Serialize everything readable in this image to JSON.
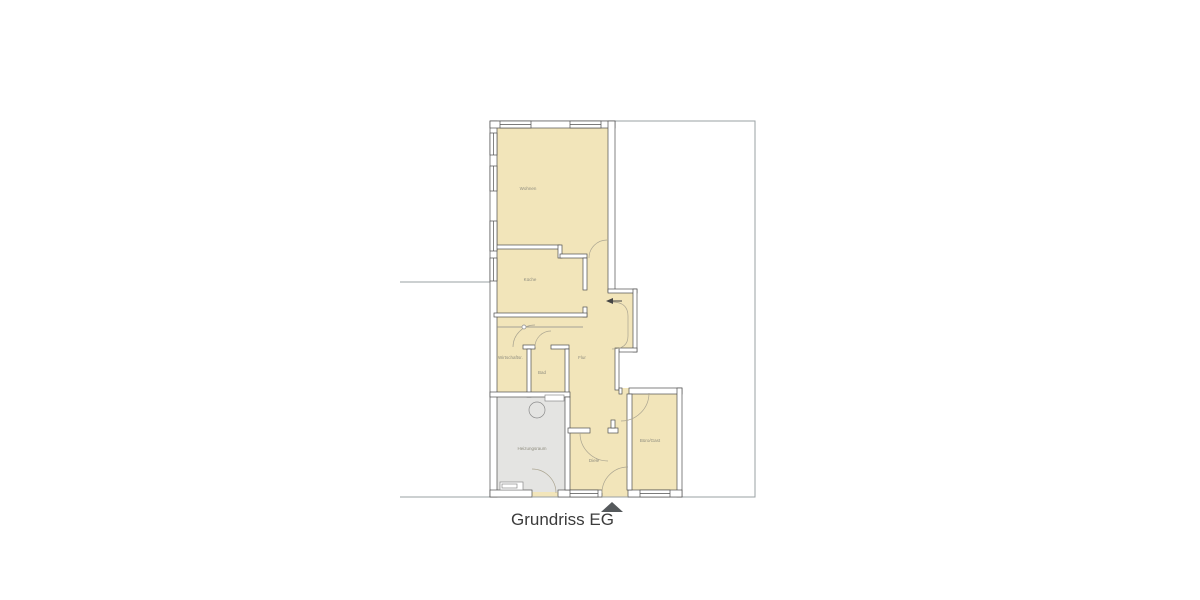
{
  "title": "Grundriss EG",
  "floor_plan": {
    "rooms": [
      {
        "name": "wohnen",
        "label": "Wohnen"
      },
      {
        "name": "kueche",
        "label": "Küche"
      },
      {
        "name": "wirtschaftsraum",
        "label": "Wirtschaftsr."
      },
      {
        "name": "bad",
        "label": "Bad"
      },
      {
        "name": "flur",
        "label": "Flur"
      },
      {
        "name": "heizungsraum",
        "label": "Heizungsraum"
      },
      {
        "name": "diele",
        "label": "Diele"
      },
      {
        "name": "buero_gast",
        "label": "Büro/Gast"
      }
    ]
  },
  "colors": {
    "room_fill": "#f2e5ba",
    "utility_fill": "#e4e4e2",
    "wall_stroke": "#4f4f4f",
    "boundary": "#9aa0a3",
    "label": "#8f8d7f",
    "title": "#3c3c3c",
    "arrow": "#55595c",
    "door_arc": "#aba591"
  }
}
